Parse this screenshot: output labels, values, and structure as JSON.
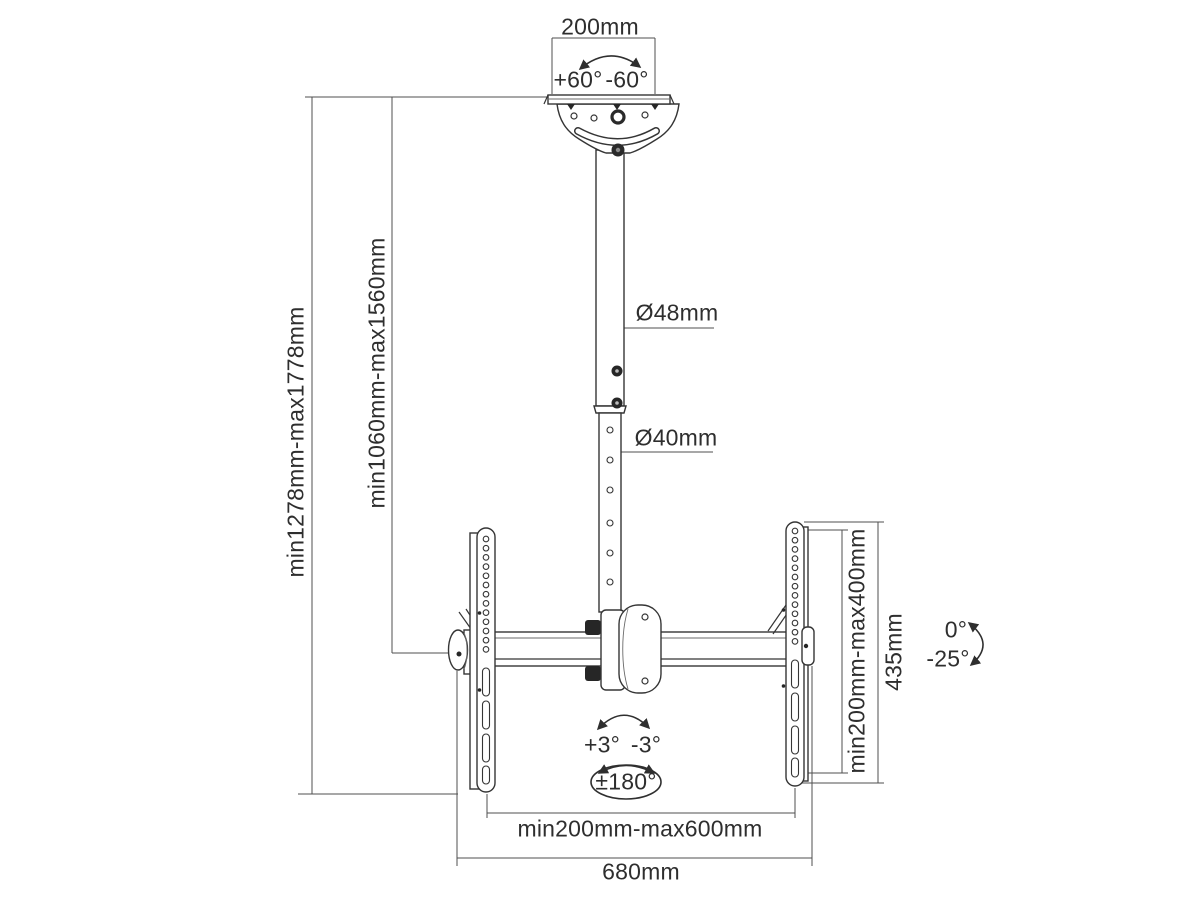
{
  "diagram": {
    "kind": "tv-ceiling-mount-dimension-drawing",
    "colors": {
      "background": "#ffffff",
      "object_line": "#353535",
      "dimension_line": "#4f4f4f",
      "text": "#2e2e2e"
    },
    "labels": {
      "ceiling_plate_width": "200mm",
      "ceiling_swivel_plus": "+60°",
      "ceiling_swivel_minus": "-60°",
      "upper_pole_diameter": "Ø48mm",
      "lower_pole_diameter": "Ø40mm",
      "overall_height_range": "min1278mm-max1778mm",
      "pole_height_range": "min1060mm-max1560mm",
      "vesa_height_range": "min200mm-max400mm",
      "bracket_height": "435mm",
      "tilt_zero": "0°",
      "tilt_down": "-25°",
      "fine_tilt_plus": "+3°",
      "fine_tilt_minus": "-3°",
      "rotation_range": "±180°",
      "vesa_width_range": "min200mm-max600mm",
      "overall_width": "680mm"
    }
  }
}
